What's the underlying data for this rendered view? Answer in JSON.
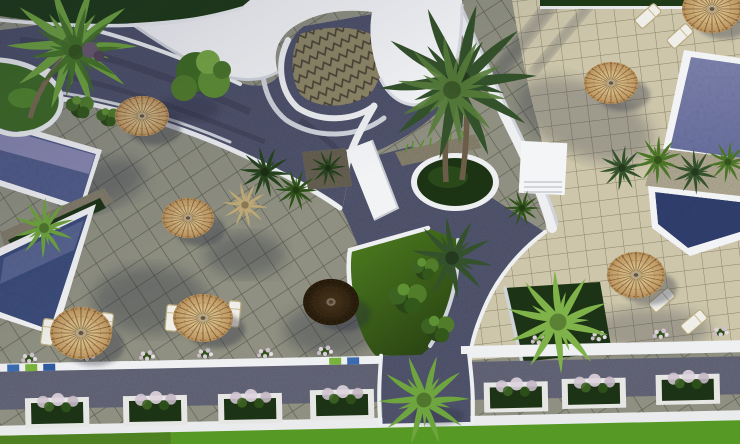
{
  "scene": {
    "title": "Aerial 3D render of a resort courtyard with pools, parasols and palm trees",
    "type": "architectural-render",
    "view": "top-down aerial"
  },
  "palette": {
    "tile_left": "#8f9081",
    "grout_left": "#5b5c4f",
    "tile_right": "#cdc6ab",
    "grout_right": "#8a8468",
    "chevron_base": "#8d8566",
    "chevron_line": "#4a4434",
    "gravel": "#565a74",
    "gravel_dark": "#4b4e63",
    "road_gravel": "#6a6c80",
    "roof_white": "#f4f5f7",
    "trim_white": "#edeff1",
    "pool_left_upper": "#55608f",
    "pool_left_lower": "#3e4f7e",
    "pool_shallow": "#9b97bd",
    "pool_right_upper": "#6a71a0",
    "pool_right_lower": "#31406f",
    "lawn_bright": "#4e7e1f",
    "lawn_dark": "#2a4513",
    "lawn_bottom": "#569a25",
    "hedge_dark": "#1e3a16",
    "bush_green": "#3d6322",
    "palm_bright": "#6fa53e",
    "palm_dark": "#33512a",
    "palm_dry": "#c2ab76",
    "trunk": "#7a6a52",
    "umbrella_tan_in": "#e6cd97",
    "umbrella_tan_out": "#b9905a",
    "umbrella_dark_in": "#46351f",
    "umbrella_dark_out": "#211708",
    "stone": "#8f8874",
    "sand": "#b9b19a",
    "planter_frame": "#e6e7e5",
    "planter_soil": "#1d3315",
    "flower_light": "#ddd3dd",
    "shadow": "#272b3c"
  },
  "objects": {
    "pools": 2,
    "parasols": 8,
    "sun_loungers": 8,
    "planter_boxes": 7,
    "palm_trees": 12,
    "building_roofs": 1,
    "lawn_areas": 3
  }
}
